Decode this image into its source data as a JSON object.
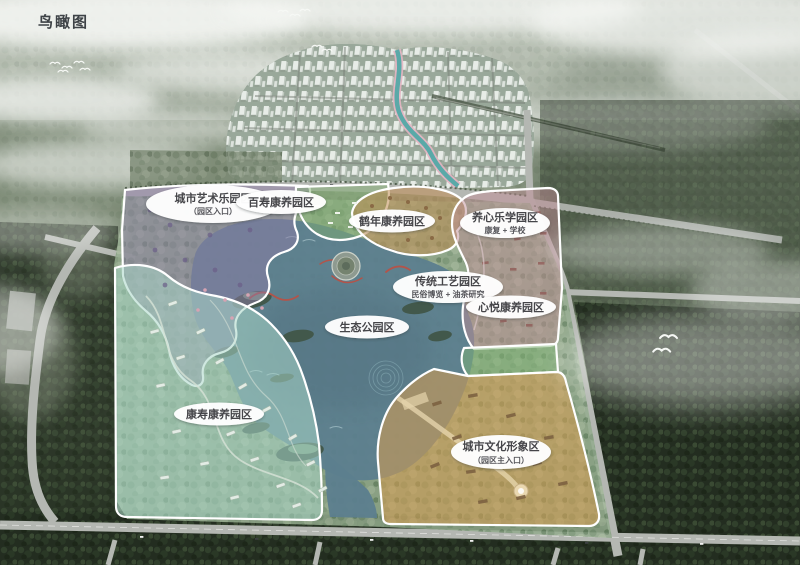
{
  "view": {
    "title": "鸟瞰图"
  },
  "zones": [
    {
      "id": "art",
      "name": "城市艺术乐园区",
      "sub": "（园区入口）",
      "color": "#8d7ba6"
    },
    {
      "id": "baishou",
      "name": "百寿康养园区",
      "sub": "",
      "color": "#7fae6f"
    },
    {
      "id": "henian",
      "name": "鹤年康养园区",
      "sub": "",
      "color": "#c08c52"
    },
    {
      "id": "yangxin",
      "name": "养心乐学园区",
      "sub": "康复 + 学校",
      "color": "#c08e96"
    },
    {
      "id": "chuantong",
      "name": "传统工艺园区",
      "sub": "民俗博览 + 油茶研究",
      "color": "#c08e96"
    },
    {
      "id": "xinyue",
      "name": "心悦康养园区",
      "sub": "",
      "color": "#c08e96"
    },
    {
      "id": "shengtai",
      "name": "生态公园区",
      "sub": "",
      "color": "#5c7e8e"
    },
    {
      "id": "kangshou",
      "name": "康寿康养园区",
      "sub": "",
      "color": "#a8d6c6"
    },
    {
      "id": "wenhua",
      "name": "城市文化形象区",
      "sub": "（园区主入口）",
      "color": "#d99d4e"
    }
  ],
  "palette": {
    "green_strip": "#7fb373",
    "road": "#b4b7b2",
    "forest_dark": "#232d20",
    "mist": "#f4f6f3"
  }
}
